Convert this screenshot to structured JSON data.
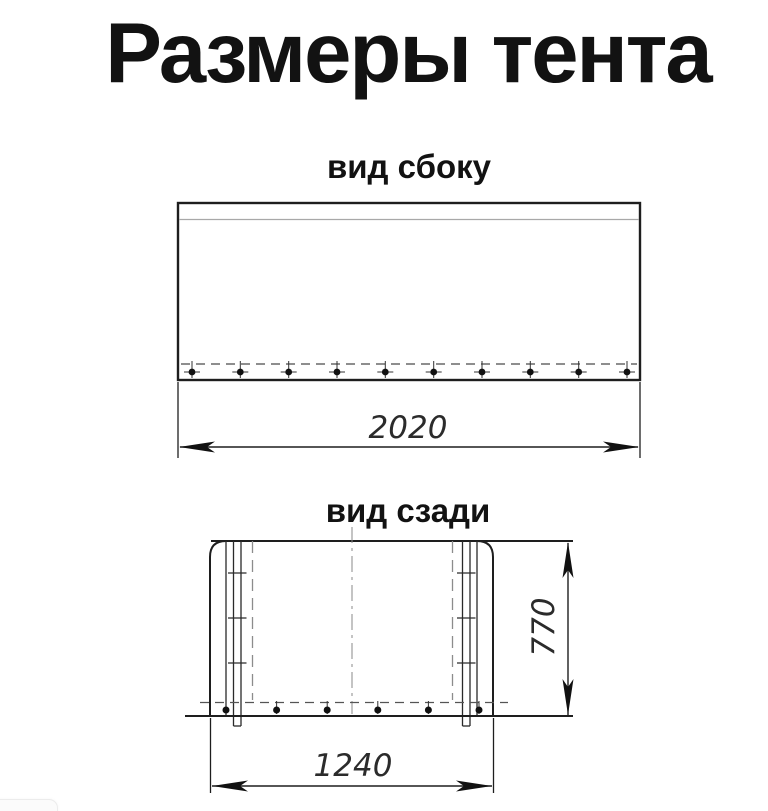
{
  "title": "Размеры тента",
  "colors": {
    "ink": "#1e1e1e",
    "thin_line": "#9a9a9a",
    "dashed_line": "#4a4a4a",
    "centerline": "#8a8a8a",
    "background": "#ffffff"
  },
  "views": {
    "side": {
      "label": "вид сбоку",
      "width_dimension": "2020"
    },
    "rear": {
      "label": "вид сзади",
      "width_dimension": "1240",
      "height_dimension": "770"
    }
  }
}
